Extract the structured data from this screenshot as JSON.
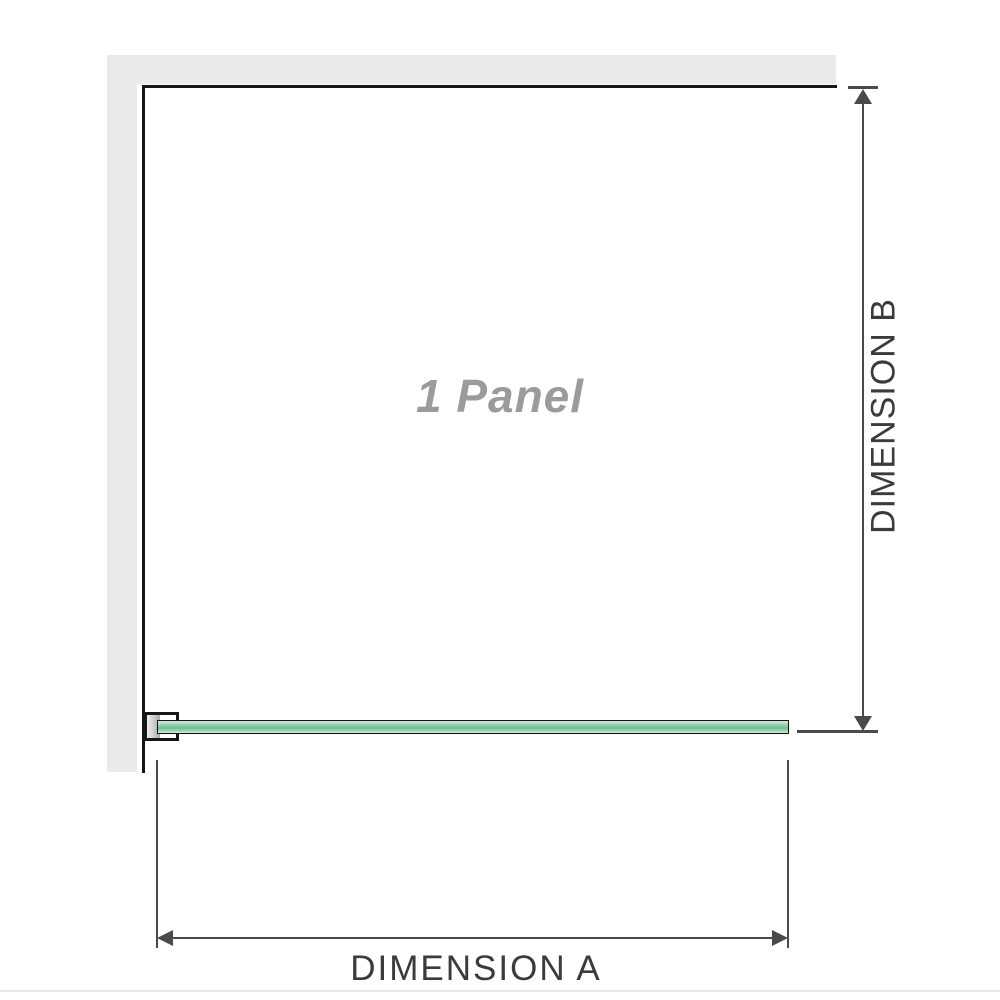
{
  "diagram": {
    "panel_label": "1 Panel",
    "dimension_a": {
      "label": "DIMENSION A"
    },
    "dimension_b": {
      "label": "DIMENSION B"
    }
  },
  "colors": {
    "background": "#ffffff",
    "wall_fill": "#eaeaea",
    "wall_edge": "#161616",
    "dimension_line": "#4a4a4a",
    "dimension_text": "#3b3b3b",
    "panel_label_text": "#9b9b9b",
    "glass_light": "#d9eede",
    "glass_mid": "#9ed6b4",
    "glass_dark": "#6fbd92",
    "bracket_shade_light": "#f0f0f0",
    "bracket_shade_dark": "#a8a8a8",
    "separator": "#e5e8e4"
  }
}
